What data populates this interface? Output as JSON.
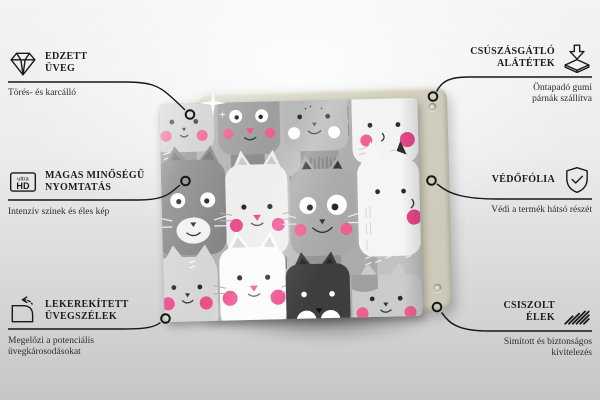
{
  "colors": {
    "background_top": "#f4f3f3",
    "background_bottom": "#c6c6c6",
    "line": "#161616",
    "text": "#1c1c1c",
    "board_beige": "#d9d6c6",
    "pattern_pink": "#ec4f8e",
    "pattern_gray_dark": "#3e3e3e",
    "pattern_gray_mid": "#9a9a9a",
    "pattern_white": "#f4f4f4"
  },
  "icons": {
    "ultra_hd_small": "ultra",
    "ultra_hd_big": "HD"
  },
  "features": {
    "left": [
      {
        "icon": "diamond-icon",
        "title": "EDZETT\nÜVEG",
        "subtitle": "Törés- és karcálló"
      },
      {
        "icon": "ultra-hd-icon",
        "title": "MAGAS MINŐSÉGŰ\nNYOMTATÁS",
        "subtitle": "Intenzív színek és éles kép"
      },
      {
        "icon": "rounded-corner-icon",
        "title": "LEKEREKÍTETT\nÜVEGSZÉLEK",
        "subtitle": "Megelőzi a potenciális\nüvegkárosodásokat"
      }
    ],
    "right": [
      {
        "icon": "arrow-down-pad-icon",
        "title": "CSÚSZÁSGÁTLÓ\nALÁTÉTEK",
        "subtitle": "Öntapadó gumi\npárnák szállítva"
      },
      {
        "icon": "shield-check-icon",
        "title": "VÉDŐFÓLIA",
        "subtitle": "Védi a termék hátsó részét"
      },
      {
        "icon": "diagonal-hatch-icon",
        "title": "CSISZOLT\nÉLEK",
        "subtitle": "Simított és biztonságos\nkivitelezés"
      }
    ]
  }
}
